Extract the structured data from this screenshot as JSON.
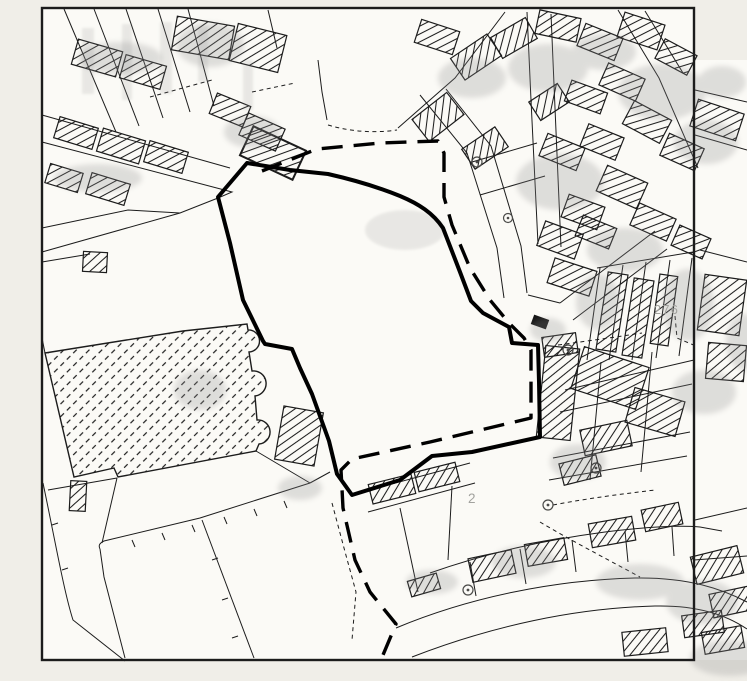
{
  "map": {
    "labels": {
      "parcel_276": "276",
      "parcel_2": "2"
    },
    "colors": {
      "paper": "#f0eee8",
      "map_bg": "#fbfaf6",
      "ink": "#1c1c1c",
      "boundary": "#000000",
      "label_gray": "#a2a29e",
      "smudge": "#8c8c8c"
    },
    "icons": {
      "well_symbol": "small circle marker",
      "hatch": "diagonal line fill for buildings"
    },
    "boundary_styles": {
      "solid": "thick solid parcel boundary",
      "dashed": "thick long-dash boundary"
    }
  }
}
